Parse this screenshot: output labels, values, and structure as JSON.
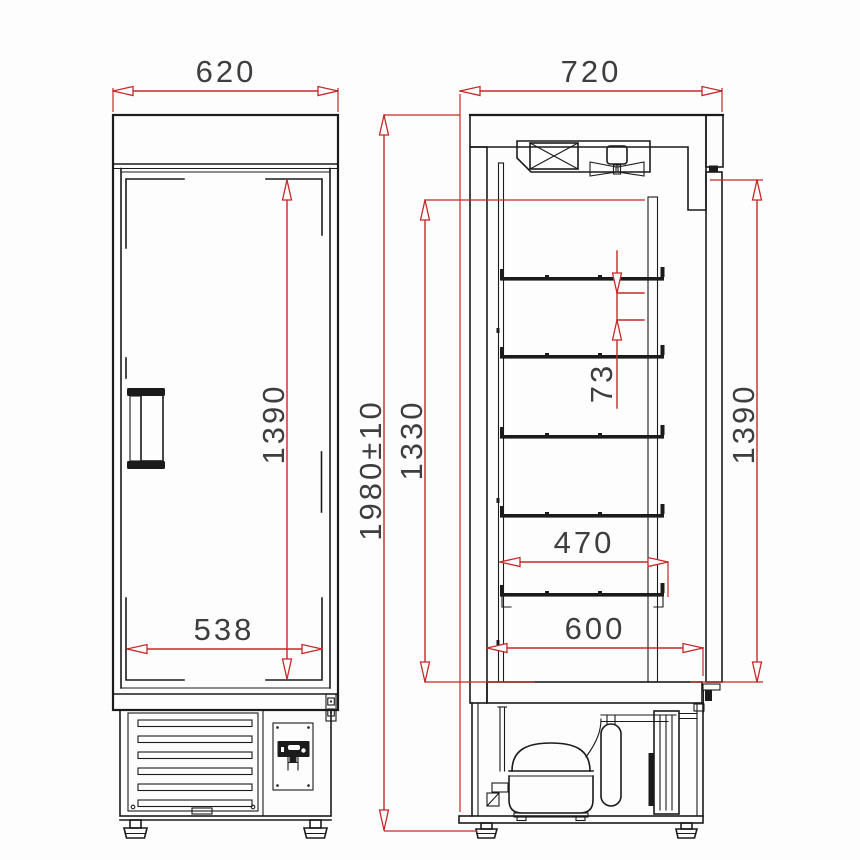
{
  "drawing": {
    "views": {
      "front_view": "refrigerated-cabinet-front-elevation",
      "section_view": "refrigerated-cabinet-side-section"
    },
    "dimensions": {
      "front_width": "620",
      "depth": "720",
      "overall_height": "1980±10",
      "interior_height": "1330",
      "door_height_front": "1390",
      "door_height_side": "1390",
      "shelf_pitch": "73",
      "shelf_depth": "470",
      "interior_depth": "600",
      "grille_width": "538"
    },
    "colors": {
      "dimension_red": "#c62828",
      "line_black": "#1b1b1b",
      "label_gray": "#3e3e3e",
      "background": "#fdfdfd"
    }
  }
}
